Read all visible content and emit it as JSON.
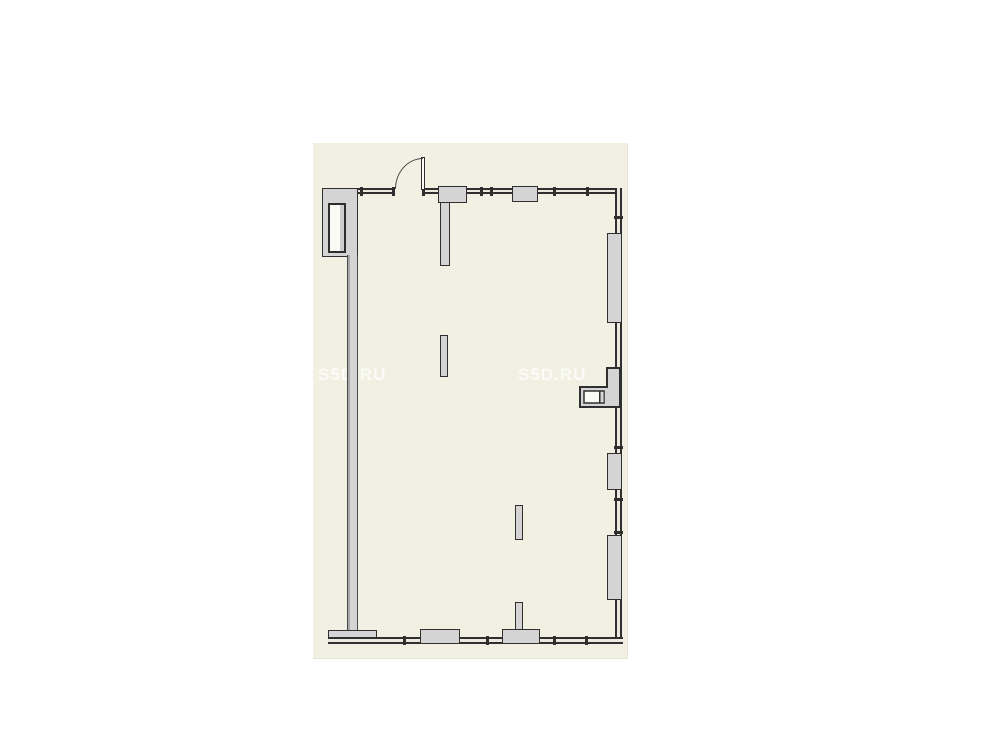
{
  "watermark": {
    "text": "S5D.RU"
  },
  "colors": {
    "page_bg": "#ffffff",
    "plan_bg": "#f1f0e2",
    "plan_edge": "#e7e6d7",
    "wall_fill": "#d4d4d4",
    "wall_shade": "#a9a9a9",
    "outline": "#2f2f2f",
    "outline_soft": "#4a4a4a",
    "band_fill": "#eceadf",
    "niche_fill": "#fbfbf6",
    "watermark_color": "rgba(255,255,255,0.72)"
  }
}
